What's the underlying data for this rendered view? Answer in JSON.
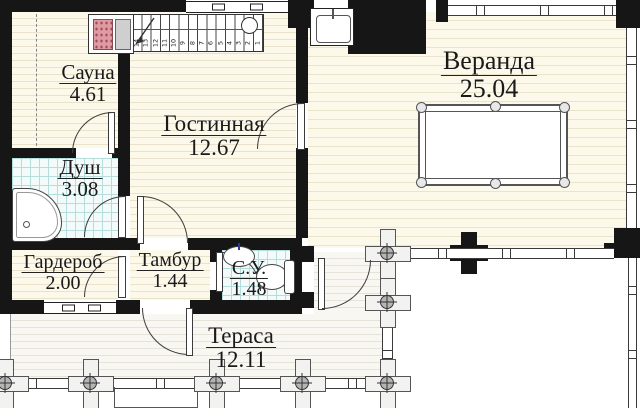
{
  "rooms": {
    "sauna": {
      "name": "Сауна",
      "area": "4.61"
    },
    "dush": {
      "name": "Душ",
      "area": "3.08"
    },
    "gostinnaya": {
      "name": "Гостинная",
      "area": "12.67"
    },
    "veranda": {
      "name": "Веранда",
      "area": "25.04"
    },
    "garderob": {
      "name": "Гардероб",
      "area": "2.00"
    },
    "tambur": {
      "name": "Тамбур",
      "area": "1.44"
    },
    "su": {
      "name": "С.У.",
      "area": "1.48"
    },
    "terasa": {
      "name": "Тераса",
      "area": "12.11"
    }
  },
  "stairs": {
    "steps": [
      "14",
      "13",
      "12",
      "11",
      "10",
      "9",
      "8",
      "7",
      "6",
      "5",
      "4",
      "3",
      "2",
      "1"
    ]
  },
  "icons": [
    "sauna-heater-icon",
    "shower-tray-icon",
    "washbasin-icon",
    "toilet-icon",
    "kitchen-sink-icon",
    "billiard-table-icon",
    "stairs-icon",
    "stair-direction-arrow-icon",
    "railing-post-icon",
    "column-cross-icon",
    "door-arc-icon",
    "window-icon",
    "fireplace-icon"
  ],
  "colors": {
    "wall": "#161616",
    "wood_floor": "#fcf8ea",
    "wood_floor_line": "#e9e3cb",
    "terrace_floor": "#f8f7f2",
    "tile_bg": "#f3fbfa",
    "tile_line": "#b4dddc",
    "heater_stones": "#de9ba3",
    "post_fill": "#b5b5b5"
  }
}
